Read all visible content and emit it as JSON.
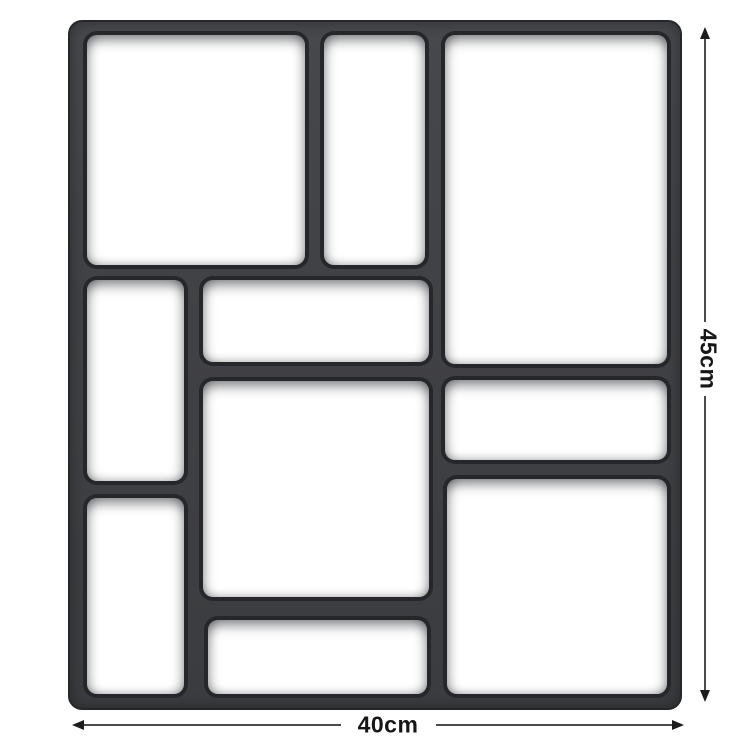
{
  "figure": {
    "type": "product-dimension-diagram",
    "subject": "paving-mold-grid",
    "cavity_count": 10
  },
  "dimensions": {
    "height_label": "45cm",
    "width_label": "40cm"
  },
  "colors": {
    "mold_body": "#414245",
    "mold_edge": "#26272a",
    "cavity_fill": "#ffffff",
    "dimension_line": "#4c4c4e",
    "dimension_text": "#161616",
    "background": "#ffffff"
  }
}
